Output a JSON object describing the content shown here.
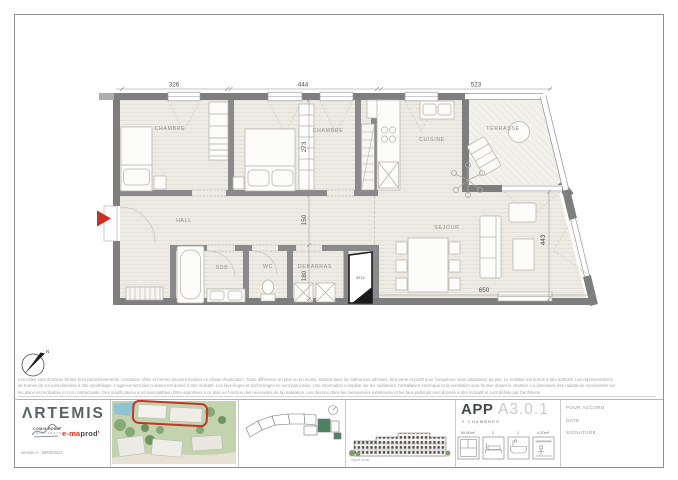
{
  "plan": {
    "rooms": {
      "chambre": "CHAMBRE",
      "cuisine": "CUISINE",
      "terrasse": "TERRASSE",
      "hall": "HALL",
      "sejour": "SEJOUR",
      "sdb": "SDB",
      "wc": "WC",
      "debarras": "DEBARRAS",
      "shaft": "AT12"
    },
    "dimensions": {
      "top": [
        "326",
        "444",
        "523"
      ],
      "middle": [
        "273",
        "150",
        "180"
      ],
      "right": "443",
      "bottom": "650"
    },
    "north_label": "N"
  },
  "disclaimer": {
    "line1": "Les côtes sont données brutes hors parachèvements. Certaines côtes et formes peuvent évoluer en phase d'exécution. Toute différence en plus ou en moins, entrant dans les tolérances admises, fera perte et profit pour l'acquéreur sans adaptation du prix. Le mobilier est donné à titre indicatif. Les représentations",
    "line2": "de trames de sol sont données à titre symbolique. L'agencement des cuisines est donné à titre indicatif. Les lave-linges et sèche-linges ne sont pas inclus. Une information complète sur les radiateurs, l'installation électrique et la ventilation sera fournie durant le chantier. La dimension des radiateurs représentés sur",
    "line3": "les plans est indicative et non contractuelle. Des modifications sont susceptibles d'être apportées à ce plan en fonction des nécessités de la réalisation. Les dessins dans les menuiseries extérieures et les faux plafonds sont donnés à titre indicatif et sont définis par l'architecte"
  },
  "title_block": {
    "brand": {
      "name": "ΛRTEMIS",
      "partner_line1": "COMIX RDBM",
      "partner_line2": "ARCHITECTS",
      "producer_prefix": "e-ma",
      "producer_suffix": "prod",
      "producer_mark": "'",
      "version": "version A - 09/03/2022"
    },
    "apartment": {
      "type": "APP",
      "subtype": "2 CHAMBRES",
      "code": "A3.0.1",
      "stats": [
        {
          "label": "90.60m²"
        },
        {
          "label": "2"
        },
        {
          "label": "1"
        },
        {
          "label": "4.20m²"
        }
      ]
    },
    "signature": {
      "approval": "POUR ACCORD",
      "date": "DATE",
      "signature": "SIGNATURE"
    },
    "elevation_caption": "façade ouest"
  },
  "colors": {
    "accent_red": "#c92f24",
    "wall_gray": "#7e7e7e",
    "brand_red": "#d03024",
    "site_green": "#4a8262"
  }
}
